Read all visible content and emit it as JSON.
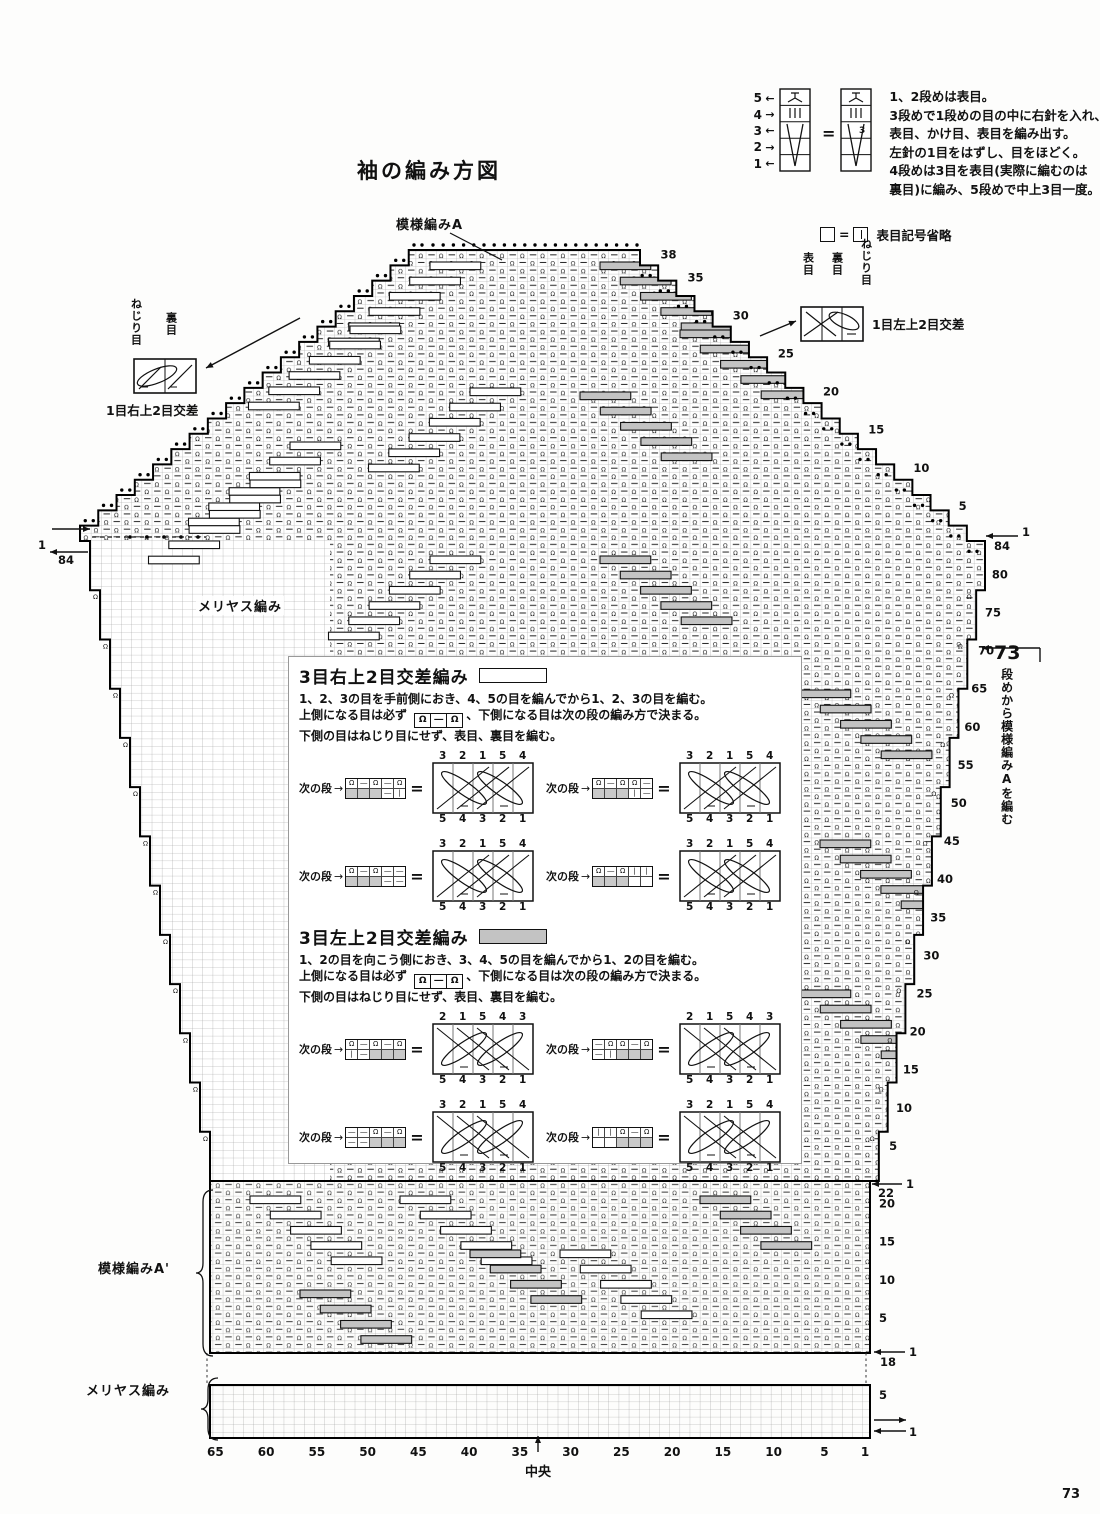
{
  "page": {
    "title": "袖の編み方図",
    "number": "73"
  },
  "glyphs": {
    "equals": "=",
    "left": "←",
    "right": "→",
    "up": "↑"
  },
  "top_legend": {
    "rows": [
      {
        "num": "5",
        "arrow": "←"
      },
      {
        "num": "4",
        "arrow": "→"
      },
      {
        "num": "3",
        "arrow": "←"
      },
      {
        "num": "2",
        "arrow": "→"
      },
      {
        "num": "1",
        "arrow": "←"
      }
    ],
    "note_lines": [
      "1、2段めは表目。",
      "3段めで1段めの目の中に右針を入れ、",
      "表目、かけ目、表目を編み出す。",
      "左針の1目をはずし、目をほどく。",
      "4段めは3目を表目(実際に編むのは",
      "裏目)に編み、5段めで中上3目一度。"
    ],
    "omit_note": "表目記号省略"
  },
  "left_cable_legend": {
    "label1": "ねじり目",
    "label2": "裏目",
    "caption": "1目右上2目交差"
  },
  "right_cable_legend": {
    "label1": "表目",
    "label2": "裏目",
    "label3": "ねじり目",
    "caption": "1目左上2目交差"
  },
  "chart": {
    "pattern_a_label": "模様編みA",
    "meriyasu_label": "メリヤス編み",
    "pattern_a2_label": "模様編みA'",
    "meriyasu_label2": "メリヤス編み",
    "center_label": "中央",
    "right_note_number": "73",
    "right_note_text": "段めから模様編みAを編む",
    "cap_row_labels": [
      38,
      35,
      30,
      25,
      20,
      15,
      10,
      5
    ],
    "body_row_labels": [
      80,
      75,
      70,
      65,
      60,
      55,
      50,
      45,
      40,
      35,
      30,
      25,
      20,
      15,
      10,
      5
    ],
    "top_left_marks": {
      "row": "1",
      "count": "84"
    },
    "top_right_marks": {
      "count": "84",
      "row": "1"
    },
    "bandA_row_labels": [
      20,
      15,
      10,
      5
    ],
    "bandA_top_marks": {
      "row": "1",
      "count": "22"
    },
    "bandA_bottom_marks": {
      "row": "1",
      "count": "18"
    },
    "bottom_band_row_label": "5",
    "bottom_band_row1": "1",
    "stitch_labels": [
      65,
      60,
      55,
      50,
      45,
      40,
      35,
      30,
      25,
      20,
      15,
      10,
      5,
      1
    ]
  },
  "inset": {
    "next_label": "次の段",
    "sections": [
      {
        "title": "3目右上2目交差編み",
        "swatch": "white",
        "line1": "1、2、3の目を手前側におき、4、5の目を編んでから1、2、3の目を編む。",
        "line2_pre": "上側になる目は必ず",
        "line2_box": [
          "Ω",
          "―",
          "Ω"
        ],
        "line2_post": "、下側になる目は次の段の編み方で決まる。",
        "line3": "下側の目はねじり目にせず、表目、裏目を編む。",
        "cross": "R",
        "examples": [
          {
            "top": [
              "3",
              "2",
              "1",
              "5",
              "4"
            ],
            "bottom": [
              "5",
              "4",
              "3",
              "2",
              "1"
            ],
            "strip_r1": [
              "Ω",
              "―",
              "Ω",
              "―",
              "Ω"
            ],
            "strip_r2": [
              "",
              "",
              "",
              "―",
              "I"
            ],
            "gray": "left"
          },
          {
            "top": [
              "3",
              "2",
              "1",
              "5",
              "4"
            ],
            "bottom": [
              "5",
              "4",
              "3",
              "2",
              "1"
            ],
            "strip_r1": [
              "Ω",
              "―",
              "Ω",
              "Ω",
              "―"
            ],
            "strip_r2": [
              "",
              "",
              "",
              "I",
              "―"
            ],
            "gray": "left"
          },
          {
            "top": [
              "3",
              "2",
              "1",
              "5",
              "4"
            ],
            "bottom": [
              "5",
              "4",
              "3",
              "2",
              "1"
            ],
            "strip_r1": [
              "Ω",
              "―",
              "Ω",
              "―",
              "―"
            ],
            "strip_r2": [
              "",
              "",
              "",
              "―",
              "―"
            ],
            "gray": "left"
          },
          {
            "top": [
              "3",
              "2",
              "1",
              "5",
              "4"
            ],
            "bottom": [
              "5",
              "4",
              "3",
              "2",
              "1"
            ],
            "strip_r1": [
              "Ω",
              "―",
              "Ω",
              "I",
              "I"
            ],
            "strip_r2": [
              "",
              "",
              "",
              "",
              ""
            ],
            "gray": "left"
          }
        ]
      },
      {
        "title": "3目左上2目交差編み",
        "swatch": "gray",
        "line1": "1、2の目を向こう側におき、3、4、5の目を編んでから1、2の目を編む。",
        "line2_pre": "上側になる目は必ず",
        "line2_box": [
          "Ω",
          "―",
          "Ω"
        ],
        "line2_post": "、下側になる目は次の段の編み方で決まる。",
        "line3": "下側の目はねじり目にせず、表目、裏目を編む。",
        "cross": "L",
        "examples": [
          {
            "top": [
              "2",
              "1",
              "5",
              "4",
              "3"
            ],
            "bottom": [
              "5",
              "4",
              "3",
              "2",
              "1"
            ],
            "strip_r1": [
              "Ω",
              "―",
              "Ω",
              "―",
              "Ω"
            ],
            "strip_r2": [
              "I",
              "―",
              "",
              "",
              ""
            ],
            "gray": "right"
          },
          {
            "top": [
              "2",
              "1",
              "5",
              "4",
              "3"
            ],
            "bottom": [
              "5",
              "4",
              "3",
              "2",
              "1"
            ],
            "strip_r1": [
              "―",
              "Ω",
              "Ω",
              "―",
              "Ω"
            ],
            "strip_r2": [
              "―",
              "I",
              "",
              "",
              ""
            ],
            "gray": "right"
          },
          {
            "top": [
              "3",
              "2",
              "1",
              "5",
              "4"
            ],
            "bottom": [
              "5",
              "4",
              "3",
              "2",
              "1"
            ],
            "strip_r1": [
              "―",
              "―",
              "Ω",
              "―",
              "Ω"
            ],
            "strip_r2": [
              "―",
              "―",
              "",
              "",
              ""
            ],
            "gray": "right"
          },
          {
            "top": [
              "3",
              "2",
              "1",
              "5",
              "4"
            ],
            "bottom": [
              "5",
              "4",
              "3",
              "2",
              "1"
            ],
            "strip_r1": [
              "I",
              "I",
              "Ω",
              "―",
              "Ω"
            ],
            "strip_r2": [
              "",
              "",
              "",
              "",
              ""
            ],
            "gray": "right"
          }
        ]
      }
    ]
  },
  "colors": {
    "ink": "#111111",
    "grid": "#9a9a9a",
    "gray_fill": "#c3c3c3"
  }
}
